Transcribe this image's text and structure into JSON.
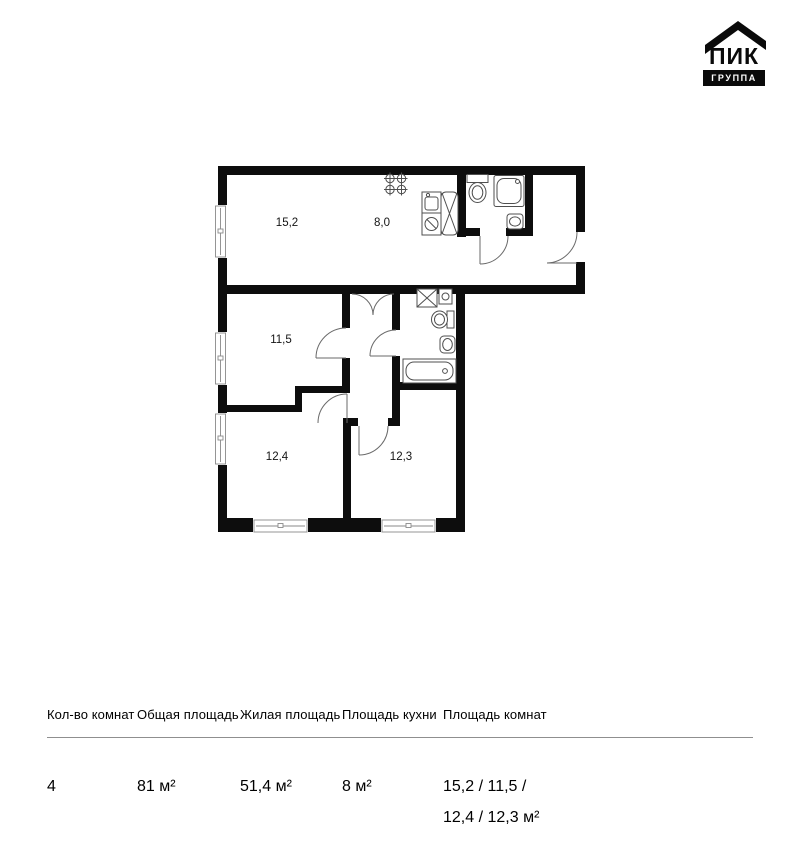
{
  "logo": {
    "brand": "ПИК",
    "group": "ГРУППА"
  },
  "plan": {
    "room_labels": {
      "living": "15,2",
      "kitchen": "8,0",
      "bedroom1": "11,5",
      "bedroom2": "12,4",
      "bedroom3": "12,3"
    }
  },
  "table": {
    "columns": [
      {
        "header": "Кол-во комнат",
        "lines": [
          "4"
        ]
      },
      {
        "header": "Общая площадь",
        "lines": [
          "81 м²"
        ]
      },
      {
        "header": "Жилая площадь",
        "lines": [
          "51,4 м²"
        ]
      },
      {
        "header": "Площадь кухни",
        "lines": [
          "8 м²"
        ]
      },
      {
        "header": "Площадь комнат",
        "lines": [
          "15,2 / 11,5 /",
          "12,4 / 12,3 м²"
        ]
      }
    ]
  }
}
